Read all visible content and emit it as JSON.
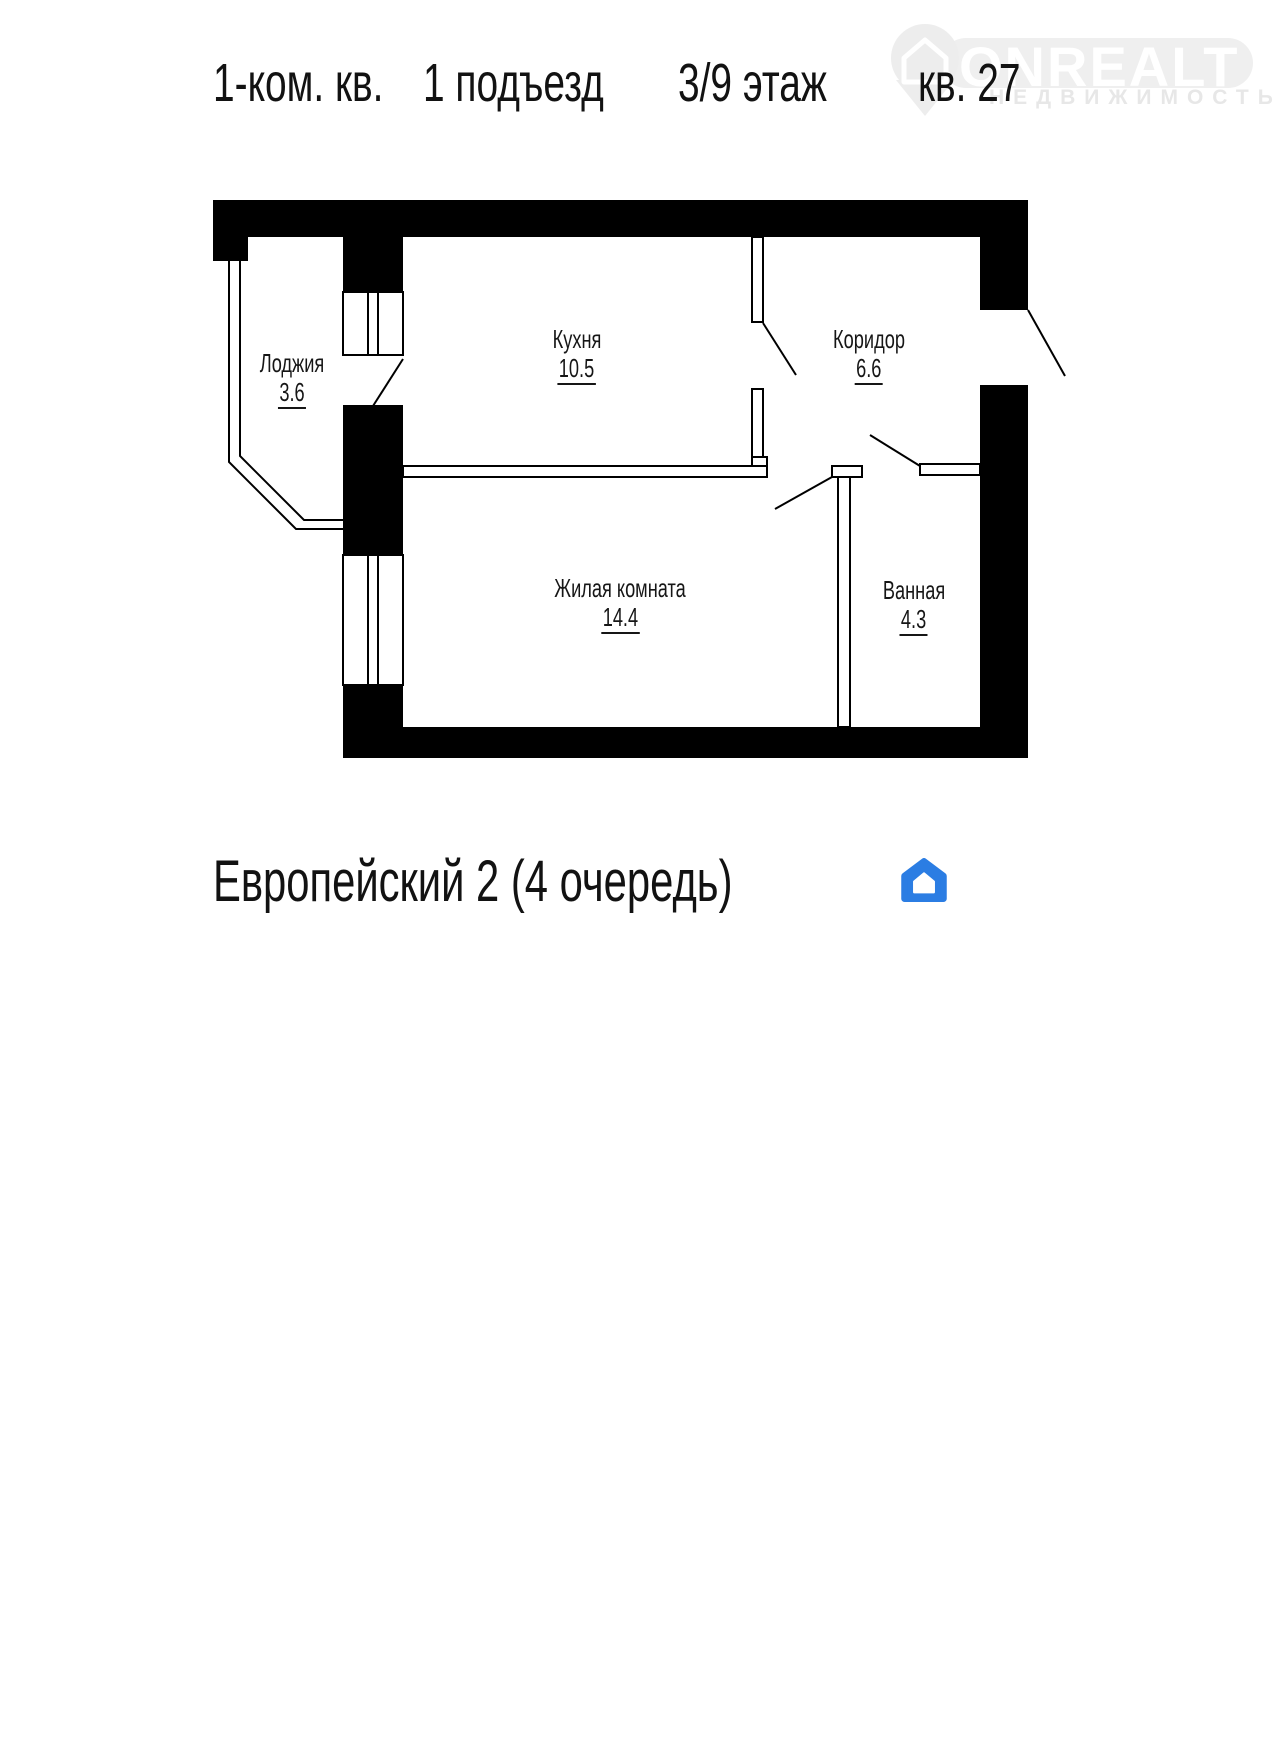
{
  "header": {
    "part1": "1-ком. кв.",
    "part2": "1 подъезд",
    "part3": "3/9 этаж",
    "apartment": "кв. 27"
  },
  "brand_watermark": {
    "name": "ONREALT",
    "subtitle": "НЕДВИЖИМОСТЬ"
  },
  "rooms": [
    {
      "name": "Лоджия",
      "area": "3.6"
    },
    {
      "name": "Кухня",
      "area": "10.5"
    },
    {
      "name": "Коридор",
      "area": "6.6"
    },
    {
      "name": "Жилая комната",
      "area": "14.4"
    },
    {
      "name": "Ванная",
      "area": "4.3"
    }
  ],
  "footer": {
    "project": "Европейский 2 (4 очередь)",
    "logo_text": "ФСН"
  },
  "colors": {
    "plan_line": "#000000",
    "wall_fill": "#000000",
    "logo_blue": "#2b7de3",
    "logo_text_color": "#23262b",
    "watermark_gray": "#ededed"
  },
  "plan": {
    "walls": [
      {
        "x": 213,
        "y": 200,
        "w": 815,
        "h": 37
      },
      {
        "x": 213,
        "y": 200,
        "w": 35,
        "h": 61
      },
      {
        "x": 343,
        "y": 237,
        "w": 60,
        "h": 55
      },
      {
        "x": 343,
        "y": 405,
        "w": 60,
        "h": 150
      },
      {
        "x": 343,
        "y": 685,
        "w": 60,
        "h": 73
      },
      {
        "x": 403,
        "y": 727,
        "w": 625,
        "h": 31
      },
      {
        "x": 980,
        "y": 237,
        "w": 48,
        "h": 73
      },
      {
        "x": 980,
        "y": 385,
        "w": 48,
        "h": 373
      }
    ],
    "thin_walls": [
      {
        "x": 752,
        "y": 237,
        "w": 11,
        "h": 85
      },
      {
        "x": 752,
        "y": 389,
        "w": 11,
        "h": 77
      },
      {
        "x": 752,
        "y": 457,
        "w": 15,
        "h": 9
      },
      {
        "x": 403,
        "y": 466,
        "w": 364,
        "h": 11
      },
      {
        "x": 832,
        "y": 466,
        "w": 30,
        "h": 11
      },
      {
        "x": 838,
        "y": 477,
        "w": 12,
        "h": 250
      },
      {
        "x": 920,
        "y": 464,
        "w": 60,
        "h": 11
      }
    ],
    "windows": [
      {
        "x": 343,
        "y": 292,
        "w": 60,
        "h": 63,
        "mullions": [
          368,
          378
        ]
      },
      {
        "x": 343,
        "y": 555,
        "w": 60,
        "h": 130,
        "mullions": [
          368,
          378
        ]
      }
    ],
    "door_swings": [
      {
        "x1": 403,
        "y1": 359,
        "x2": 373,
        "y2": 406
      },
      {
        "x1": 763,
        "y1": 323,
        "x2": 796,
        "y2": 375
      },
      {
        "x1": 832,
        "y1": 477,
        "x2": 775,
        "y2": 509
      },
      {
        "x1": 920,
        "y1": 466,
        "x2": 870,
        "y2": 435
      },
      {
        "x1": 1028,
        "y1": 310,
        "x2": 1065,
        "y2": 376
      }
    ],
    "loggia_walls": [
      "229,261 229,462 296,529 343,529",
      "240,261 240,456 304,520 343,520"
    ]
  }
}
